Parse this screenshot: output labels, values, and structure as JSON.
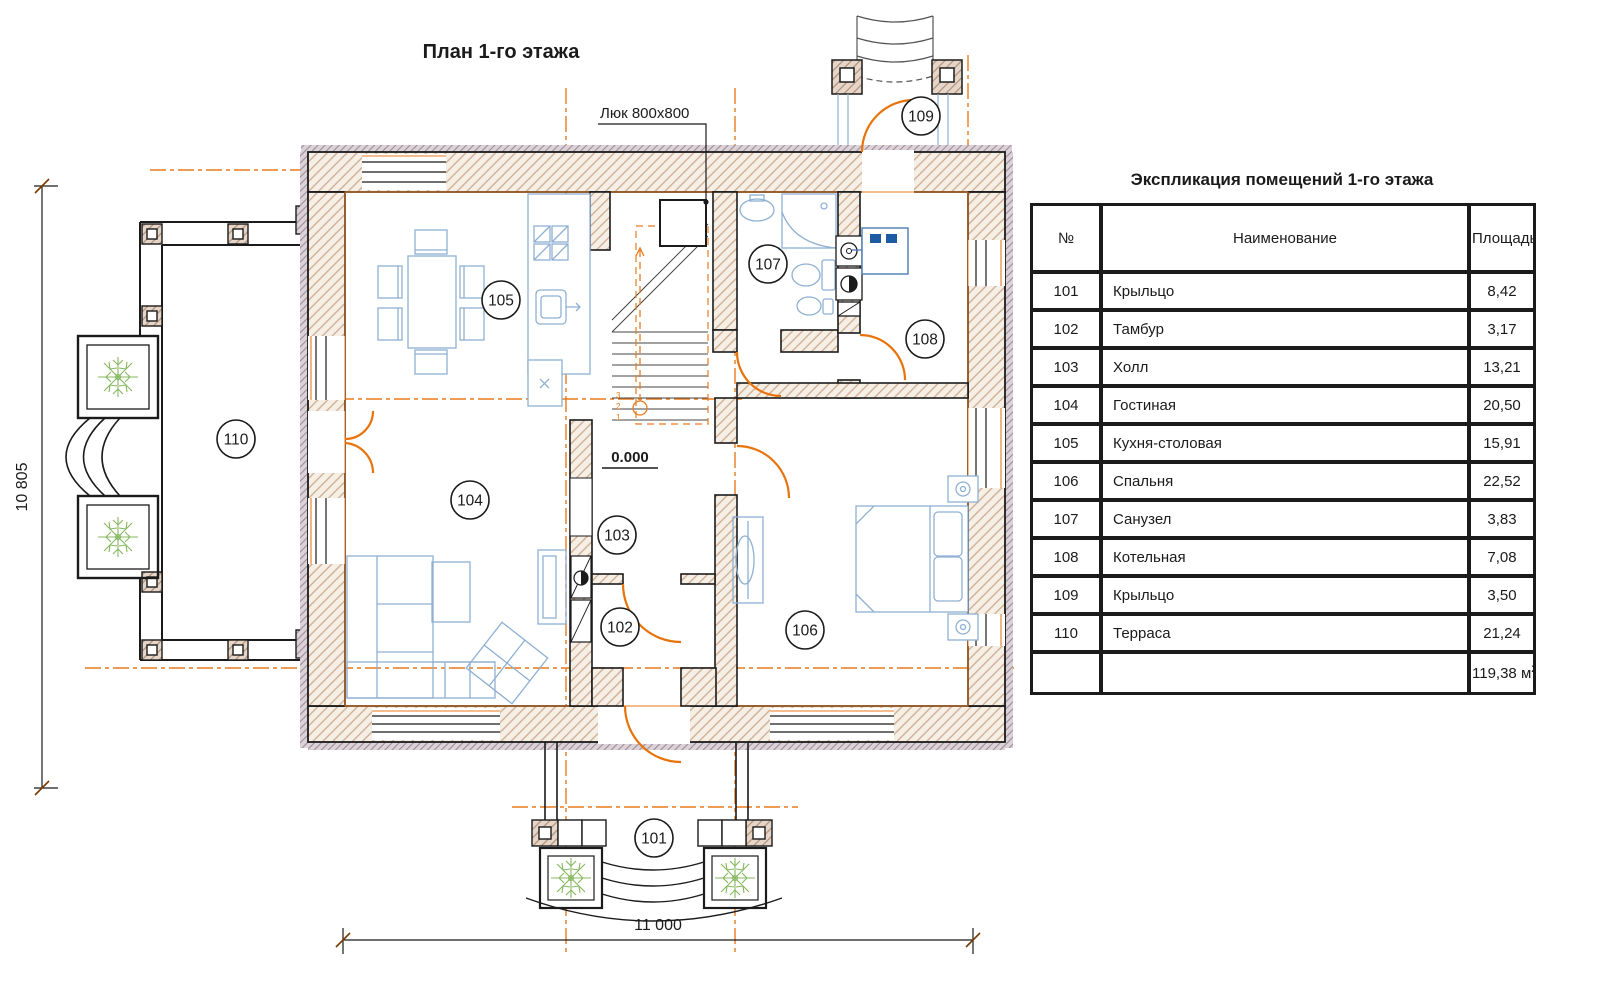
{
  "plan": {
    "title": "План 1-го этажа",
    "hatch_label": "Люк 800x800",
    "elevation_mark": "0.000",
    "dim_height": "10 805",
    "dim_width": "11 000",
    "stair_steps": [
      "1",
      "2",
      "3"
    ],
    "accent_orange": "#e87a1f",
    "furniture_blue": "#8fb0d2",
    "plant_green": "#86b860",
    "room_labels": [
      {
        "id": "101",
        "x": 654,
        "y": 838
      },
      {
        "id": "102",
        "x": 620,
        "y": 627
      },
      {
        "id": "103",
        "x": 617,
        "y": 535
      },
      {
        "id": "104",
        "x": 470,
        "y": 500
      },
      {
        "id": "105",
        "x": 501,
        "y": 300
      },
      {
        "id": "106",
        "x": 805,
        "y": 630
      },
      {
        "id": "107",
        "x": 768,
        "y": 264
      },
      {
        "id": "108",
        "x": 925,
        "y": 339
      },
      {
        "id": "109",
        "x": 921,
        "y": 116
      },
      {
        "id": "110",
        "x": 236,
        "y": 439
      }
    ]
  },
  "table": {
    "title": "Экспликация помещений 1-го этажа",
    "columns": [
      "№",
      "Наименование",
      "Площадь"
    ],
    "rows": [
      {
        "num": "101",
        "name": "Крыльцо",
        "area": "8,42"
      },
      {
        "num": "102",
        "name": "Тамбур",
        "area": "3,17"
      },
      {
        "num": "103",
        "name": "Холл",
        "area": "13,21"
      },
      {
        "num": "104",
        "name": "Гостиная",
        "area": "20,50"
      },
      {
        "num": "105",
        "name": "Кухня-столовая",
        "area": "15,91"
      },
      {
        "num": "106",
        "name": "Спальня",
        "area": "22,52"
      },
      {
        "num": "107",
        "name": "Санузел",
        "area": "3,83"
      },
      {
        "num": "108",
        "name": "Котельная",
        "area": "7,08"
      },
      {
        "num": "109",
        "name": "Крыльцо",
        "area": "3,50"
      },
      {
        "num": "110",
        "name": "Терраса",
        "area": "21,24"
      }
    ],
    "total_area": "119,38",
    "total_unit": "м",
    "total_sup": "2"
  }
}
